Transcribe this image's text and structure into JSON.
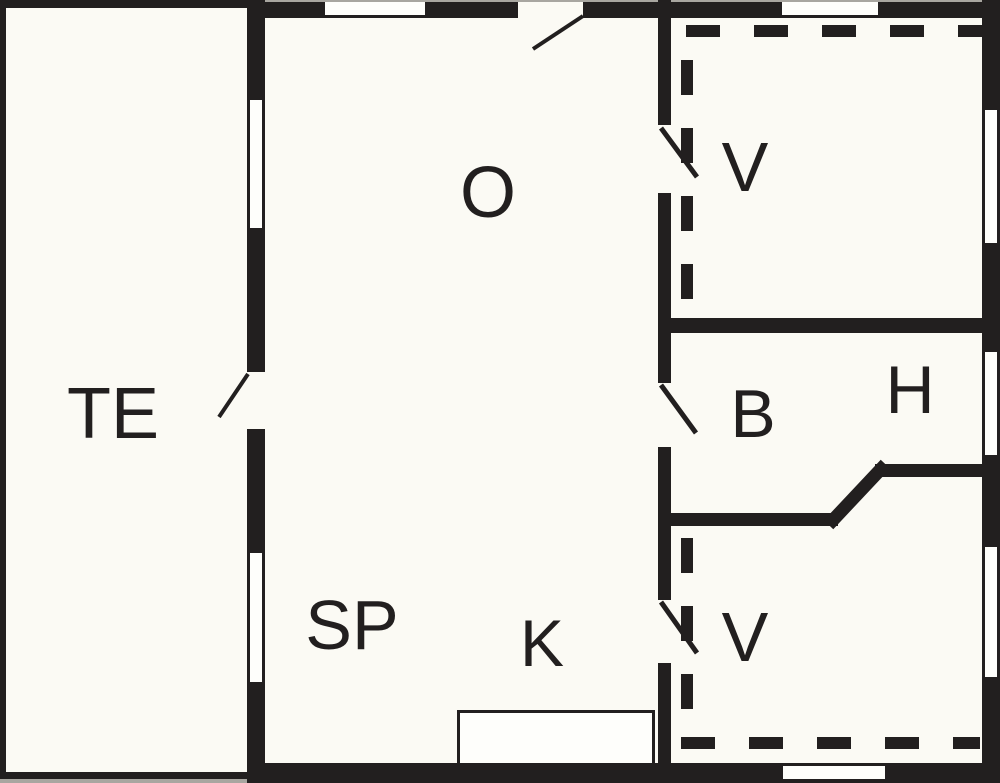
{
  "title": "Summer house floor plan",
  "colors": {
    "ink": "#221f1f",
    "paper": "#fbfaf4",
    "window": "#fefefb",
    "edge": "#a8a6a0"
  },
  "rooms": {
    "te": {
      "label": "TE"
    },
    "o": {
      "label": "O"
    },
    "v_top": {
      "label": "V"
    },
    "b": {
      "label": "B"
    },
    "h": {
      "label": "H"
    },
    "sp": {
      "label": "SP"
    },
    "k": {
      "label": "K"
    },
    "v_bottom": {
      "label": "V"
    }
  }
}
